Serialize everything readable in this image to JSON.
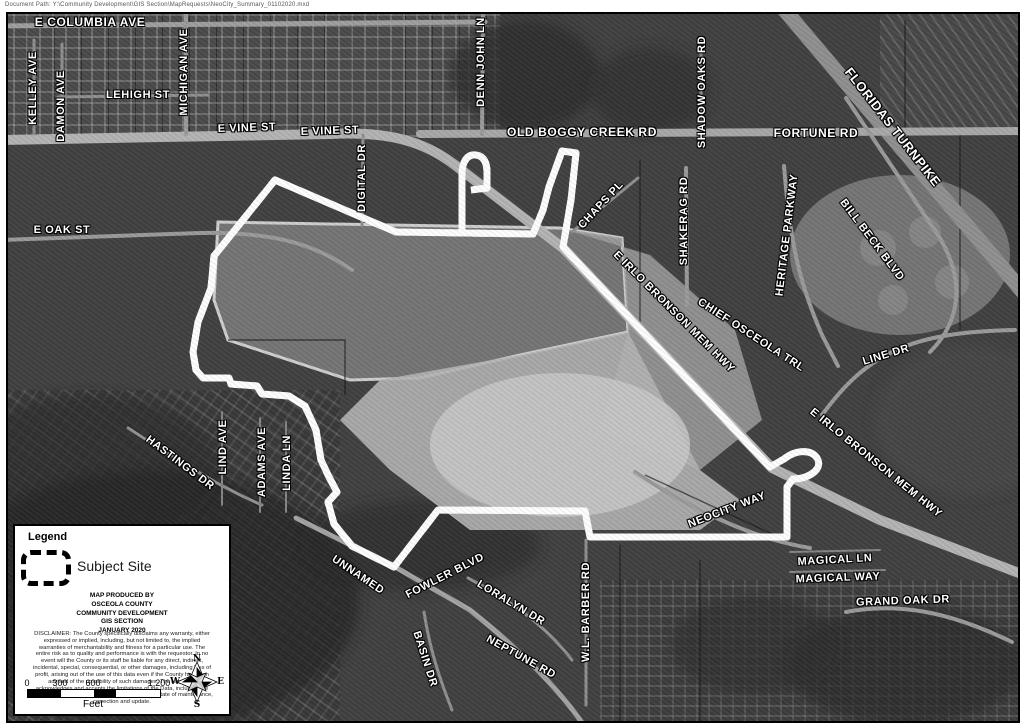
{
  "header": {
    "document_path": "Document Path: Y:\\Community Development\\GIS Section\\MapRequests\\NeoCity_Summary_01102020.mxd"
  },
  "map": {
    "road_labels": [
      {
        "text": "E COLUMBIA AVE",
        "x": 90,
        "y": 22,
        "rot": 0,
        "fs": 12
      },
      {
        "text": "KELLEY AVE",
        "x": 33,
        "y": 88,
        "rot": -90,
        "fs": 11
      },
      {
        "text": "DAMON AVE",
        "x": 61,
        "y": 106,
        "rot": -90,
        "fs": 11
      },
      {
        "text": "LEHIGH ST",
        "x": 138,
        "y": 95,
        "rot": 0,
        "fs": 11
      },
      {
        "text": "MICHIGAN AVE",
        "x": 184,
        "y": 72,
        "rot": -90,
        "fs": 11
      },
      {
        "text": "E VINE ST",
        "x": 247,
        "y": 128,
        "rot": -2,
        "fs": 11
      },
      {
        "text": "E VINE ST",
        "x": 330,
        "y": 131,
        "rot": -2,
        "fs": 11
      },
      {
        "text": "DENN JOHN LN",
        "x": 481,
        "y": 62,
        "rot": -90,
        "fs": 11
      },
      {
        "text": "OLD BOGGY CREEK RD",
        "x": 582,
        "y": 132,
        "rot": 0,
        "fs": 12
      },
      {
        "text": "SHADOW OAKS RD",
        "x": 702,
        "y": 92,
        "rot": -90,
        "fs": 11
      },
      {
        "text": "FORTUNE RD",
        "x": 816,
        "y": 133,
        "rot": 0,
        "fs": 12
      },
      {
        "text": "FLORIDAS TURNPIKE",
        "x": 893,
        "y": 127,
        "rot": 52,
        "fs": 13
      },
      {
        "text": "CHAPS PL",
        "x": 601,
        "y": 205,
        "rot": -47,
        "fs": 11
      },
      {
        "text": "SHAKERAG RD",
        "x": 684,
        "y": 221,
        "rot": -90,
        "fs": 11
      },
      {
        "text": "HERITAGE PARKWAY",
        "x": 787,
        "y": 235,
        "rot": -83,
        "fs": 11
      },
      {
        "text": "BILL BECK BLVD",
        "x": 872,
        "y": 240,
        "rot": 53,
        "fs": 11
      },
      {
        "text": "E IRLO BRONSON MEM HWY",
        "x": 674,
        "y": 312,
        "rot": 45,
        "fs": 11
      },
      {
        "text": "CHIEF OSCEOLA TRL",
        "x": 751,
        "y": 335,
        "rot": 33,
        "fs": 11
      },
      {
        "text": "LINE DR",
        "x": 886,
        "y": 355,
        "rot": -17,
        "fs": 11
      },
      {
        "text": "E IRLO BRONSON MEM HWY",
        "x": 876,
        "y": 463,
        "rot": 39,
        "fs": 11
      },
      {
        "text": "DIGITAL DR",
        "x": 362,
        "y": 178,
        "rot": -90,
        "fs": 11
      },
      {
        "text": "E OAK ST",
        "x": 62,
        "y": 230,
        "rot": 0,
        "fs": 11
      },
      {
        "text": "HASTINGS DR",
        "x": 180,
        "y": 463,
        "rot": 37,
        "fs": 11
      },
      {
        "text": "LIND AVE",
        "x": 223,
        "y": 447,
        "rot": -90,
        "fs": 11
      },
      {
        "text": "ADAMS AVE",
        "x": 262,
        "y": 462,
        "rot": -90,
        "fs": 11
      },
      {
        "text": "LINDA LN",
        "x": 287,
        "y": 463,
        "rot": -90,
        "fs": 11
      },
      {
        "text": "NEOCITY WAY",
        "x": 727,
        "y": 510,
        "rot": -21,
        "fs": 11
      },
      {
        "text": "MAGICAL LN",
        "x": 835,
        "y": 560,
        "rot": -3,
        "fs": 11
      },
      {
        "text": "MAGICAL WAY",
        "x": 838,
        "y": 578,
        "rot": -2,
        "fs": 11
      },
      {
        "text": "GRAND OAK DR",
        "x": 903,
        "y": 601,
        "rot": -2,
        "fs": 11
      },
      {
        "text": "UNNAMED",
        "x": 358,
        "y": 575,
        "rot": 34,
        "fs": 11
      },
      {
        "text": "FOWLER BLVD",
        "x": 445,
        "y": 576,
        "rot": -27,
        "fs": 11
      },
      {
        "text": "LORALYN DR",
        "x": 511,
        "y": 603,
        "rot": 31,
        "fs": 11
      },
      {
        "text": "BASIN DR",
        "x": 425,
        "y": 659,
        "rot": 72,
        "fs": 11
      },
      {
        "text": "NEPTUNE RD",
        "x": 521,
        "y": 657,
        "rot": 29,
        "fs": 11
      },
      {
        "text": "W.L. BARBER RD",
        "x": 586,
        "y": 612,
        "rot": -90,
        "fs": 11
      }
    ]
  },
  "legend": {
    "title": "Legend",
    "subject_site_label": "Subject Site",
    "produced_by_lines": [
      "MAP PRODUCED BY",
      "OSCEOLA COUNTY",
      "COMMUNITY DEVELOPMENT",
      "GIS SECTION",
      "JANUARY 2020"
    ],
    "disclaimer": "DISCLAIMER:  The County specifically disclaims any warranty, either expressed or implied, including, but not limited to, the implied warranties of merchantability and fitness for a particular use. The entire risk as to quality and performance is with the requestor. In no event will the County or its staff be liable for any direct, indirect, incidental, special, consequential, or other damages, including loss of profit, arising out of the use of this data even if the County has been advised of the possibility of such damages. The requestor acknowledges and accepts the limitations of the Data, including the fact that the Data is dynamic and is in a constant state of maintenance, correction and update."
  },
  "scale_bar": {
    "ticks": [
      "0",
      "300",
      "600",
      "1,200"
    ],
    "unit_label": "Feet"
  },
  "compass": {
    "north": "N",
    "south": "S",
    "east": "E",
    "west": "W"
  },
  "colors": {
    "boundary": "#000000",
    "boundary_casing": "#ffffff",
    "label_fill": "#ffffff",
    "label_halo": "#000000"
  }
}
